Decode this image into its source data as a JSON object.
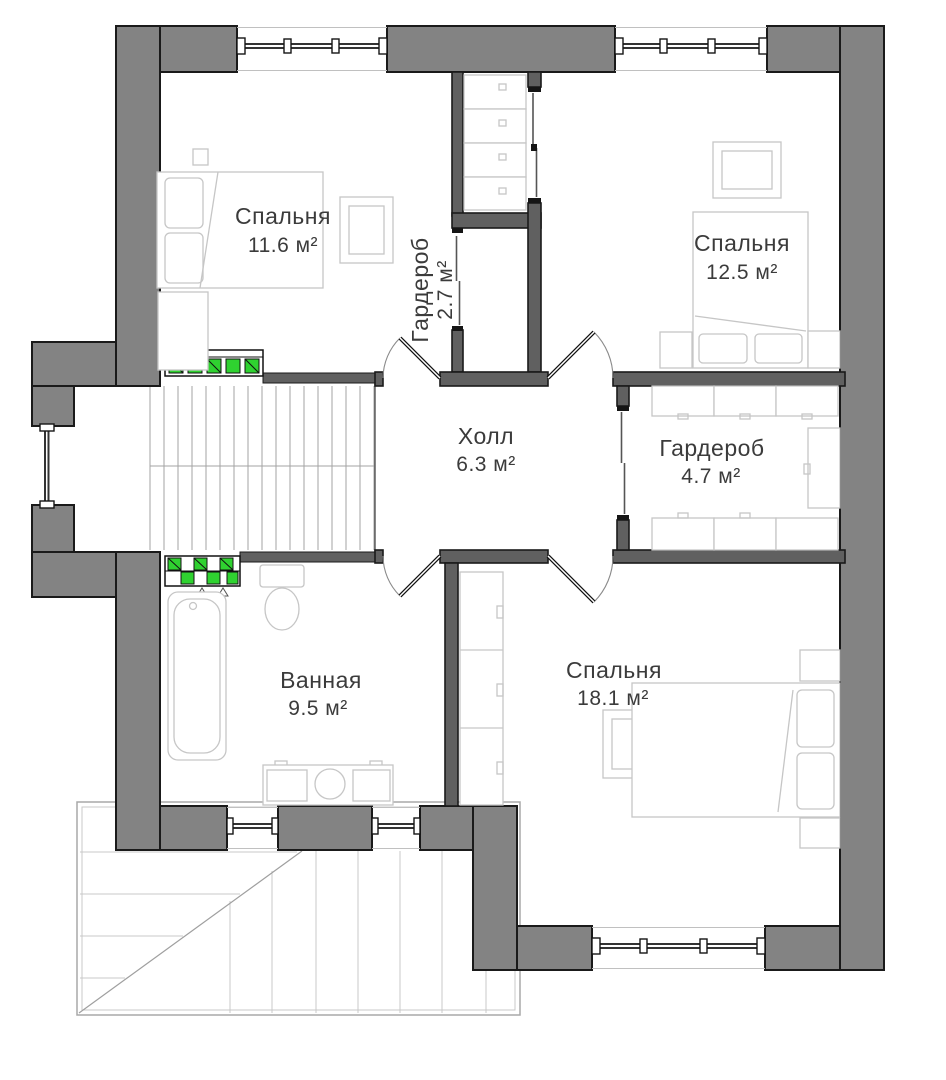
{
  "rooms": [
    {
      "id": "bedroom-1",
      "name": "Спальня",
      "area": "11.6 м²"
    },
    {
      "id": "wardrobe-1",
      "name": "Гардероб",
      "area": "2.7 м²"
    },
    {
      "id": "bedroom-2",
      "name": "Спальня",
      "area": "12.5 м²"
    },
    {
      "id": "hall",
      "name": "Холл",
      "area": "6.3 м²"
    },
    {
      "id": "wardrobe-2",
      "name": "Гардероб",
      "area": "4.7 м²"
    },
    {
      "id": "bathroom",
      "name": "Ванная",
      "area": "9.5 м²"
    },
    {
      "id": "bedroom-3",
      "name": "Спальня",
      "area": "18.1 м²"
    }
  ],
  "colors": {
    "exterior_wall": "#838383",
    "interior_wall": "#606060",
    "wall_outline": "#1a1a1a",
    "accent_green": "#2fd230",
    "furniture_line": "#c6c6c6",
    "label_text": "#3b3b3b"
  }
}
